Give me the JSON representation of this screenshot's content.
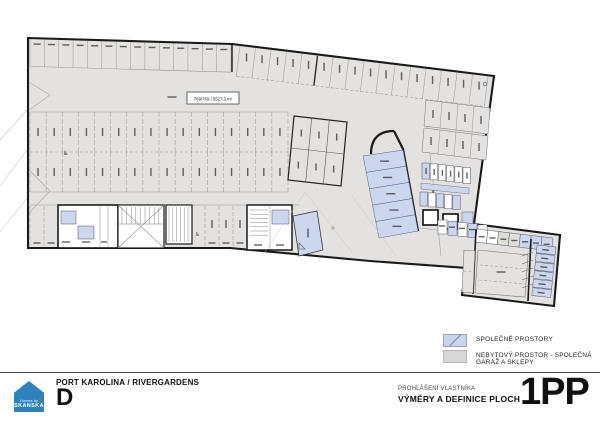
{
  "colors": {
    "garage_fill": "#e3e2e0",
    "common_fill": "#ccd7ef",
    "wall": "#1a1a1a",
    "thin": "#9a9a9a",
    "faint": "#c6c6c6",
    "micro": "#3c3c3c",
    "brand_blue": "#2e82bd"
  },
  "icons": {
    "wheelchair": "♿"
  },
  "plan": {
    "area_label": "769/769 | 5527,3 m²",
    "stall_counts": {
      "top_row_left": 14,
      "top_row_right": 16,
      "middle_row_upper": 16,
      "middle_row_lower": 16,
      "center_block_cols": 3,
      "center_block_rows": 2
    },
    "common_room_stack": 5,
    "wing_cells": 6,
    "wing_top_cells": 7
  },
  "legend": {
    "items": [
      {
        "key": "common",
        "label": "SPOLEČNÉ PROSTORY"
      },
      {
        "key": "garage",
        "label": "NEBYTOVÝ PROSTOR - SPOLEČNÁ GARÁŽ A SKLEPY"
      }
    ]
  },
  "footer": {
    "project": "PORT KAROLINA / RIVERGARDENS",
    "building": "D",
    "doc_type": "PROHLÁŠENÍ VLASTNÍKA",
    "doc_title": "VÝMĚRY A DEFINICE PLOCH",
    "floor": "1PP",
    "logo_text": "SKANSKA",
    "logo_subtext": "Homes by"
  }
}
